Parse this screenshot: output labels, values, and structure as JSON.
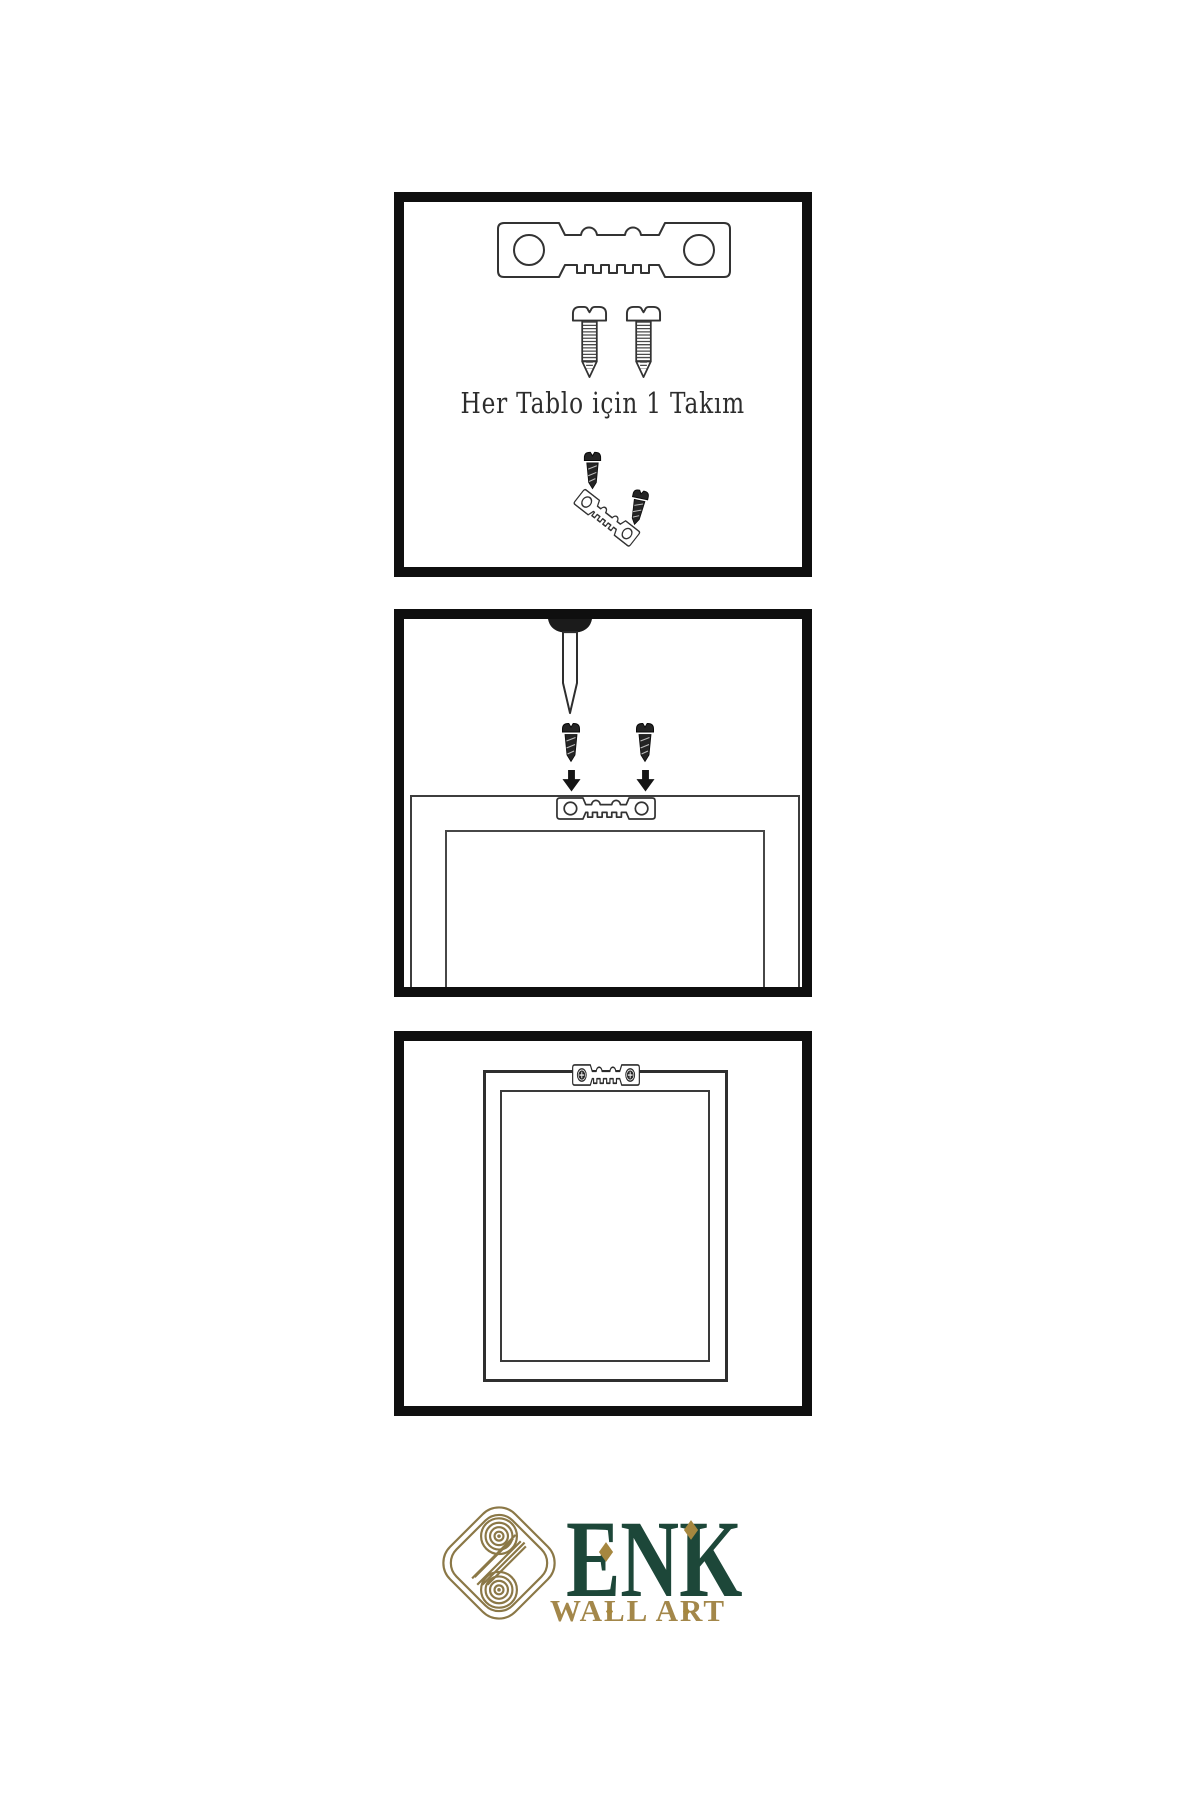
{
  "page": {
    "width": 1200,
    "height": 1800,
    "background": "#ffffff"
  },
  "colors": {
    "panel_border": "#0f0f0f",
    "illustration_line": "#333333",
    "dark_hardware": "#242424",
    "brand_green": "#1d4739",
    "brand_gold": "#a3874a",
    "brand_gold_diamond": "#a6873f",
    "knot_gold": "#8b7847"
  },
  "panel_kit": {
    "caption": "Her Tablo için 1 Takım",
    "icons": [
      "sawtooth-hanger-icon",
      "screw-icon",
      "screw-icon",
      "mini-screw-icon",
      "tilted-sawtooth-hanger-icon",
      "mini-screw-icon"
    ]
  },
  "panel_mounting": {
    "icons": [
      "nail-icon",
      "dark-screw-icon",
      "dark-screw-icon",
      "arrow-down-icon",
      "arrow-down-icon",
      "frame-back-icon",
      "sawtooth-hanger-icon"
    ]
  },
  "panel_hung": {
    "icons": [
      "frame-back-icon",
      "mounted-sawtooth-hanger-icon"
    ]
  },
  "logo": {
    "mark": "interlaced-knot-icon",
    "brand": "ENK",
    "subtitle": "WALL ART"
  }
}
